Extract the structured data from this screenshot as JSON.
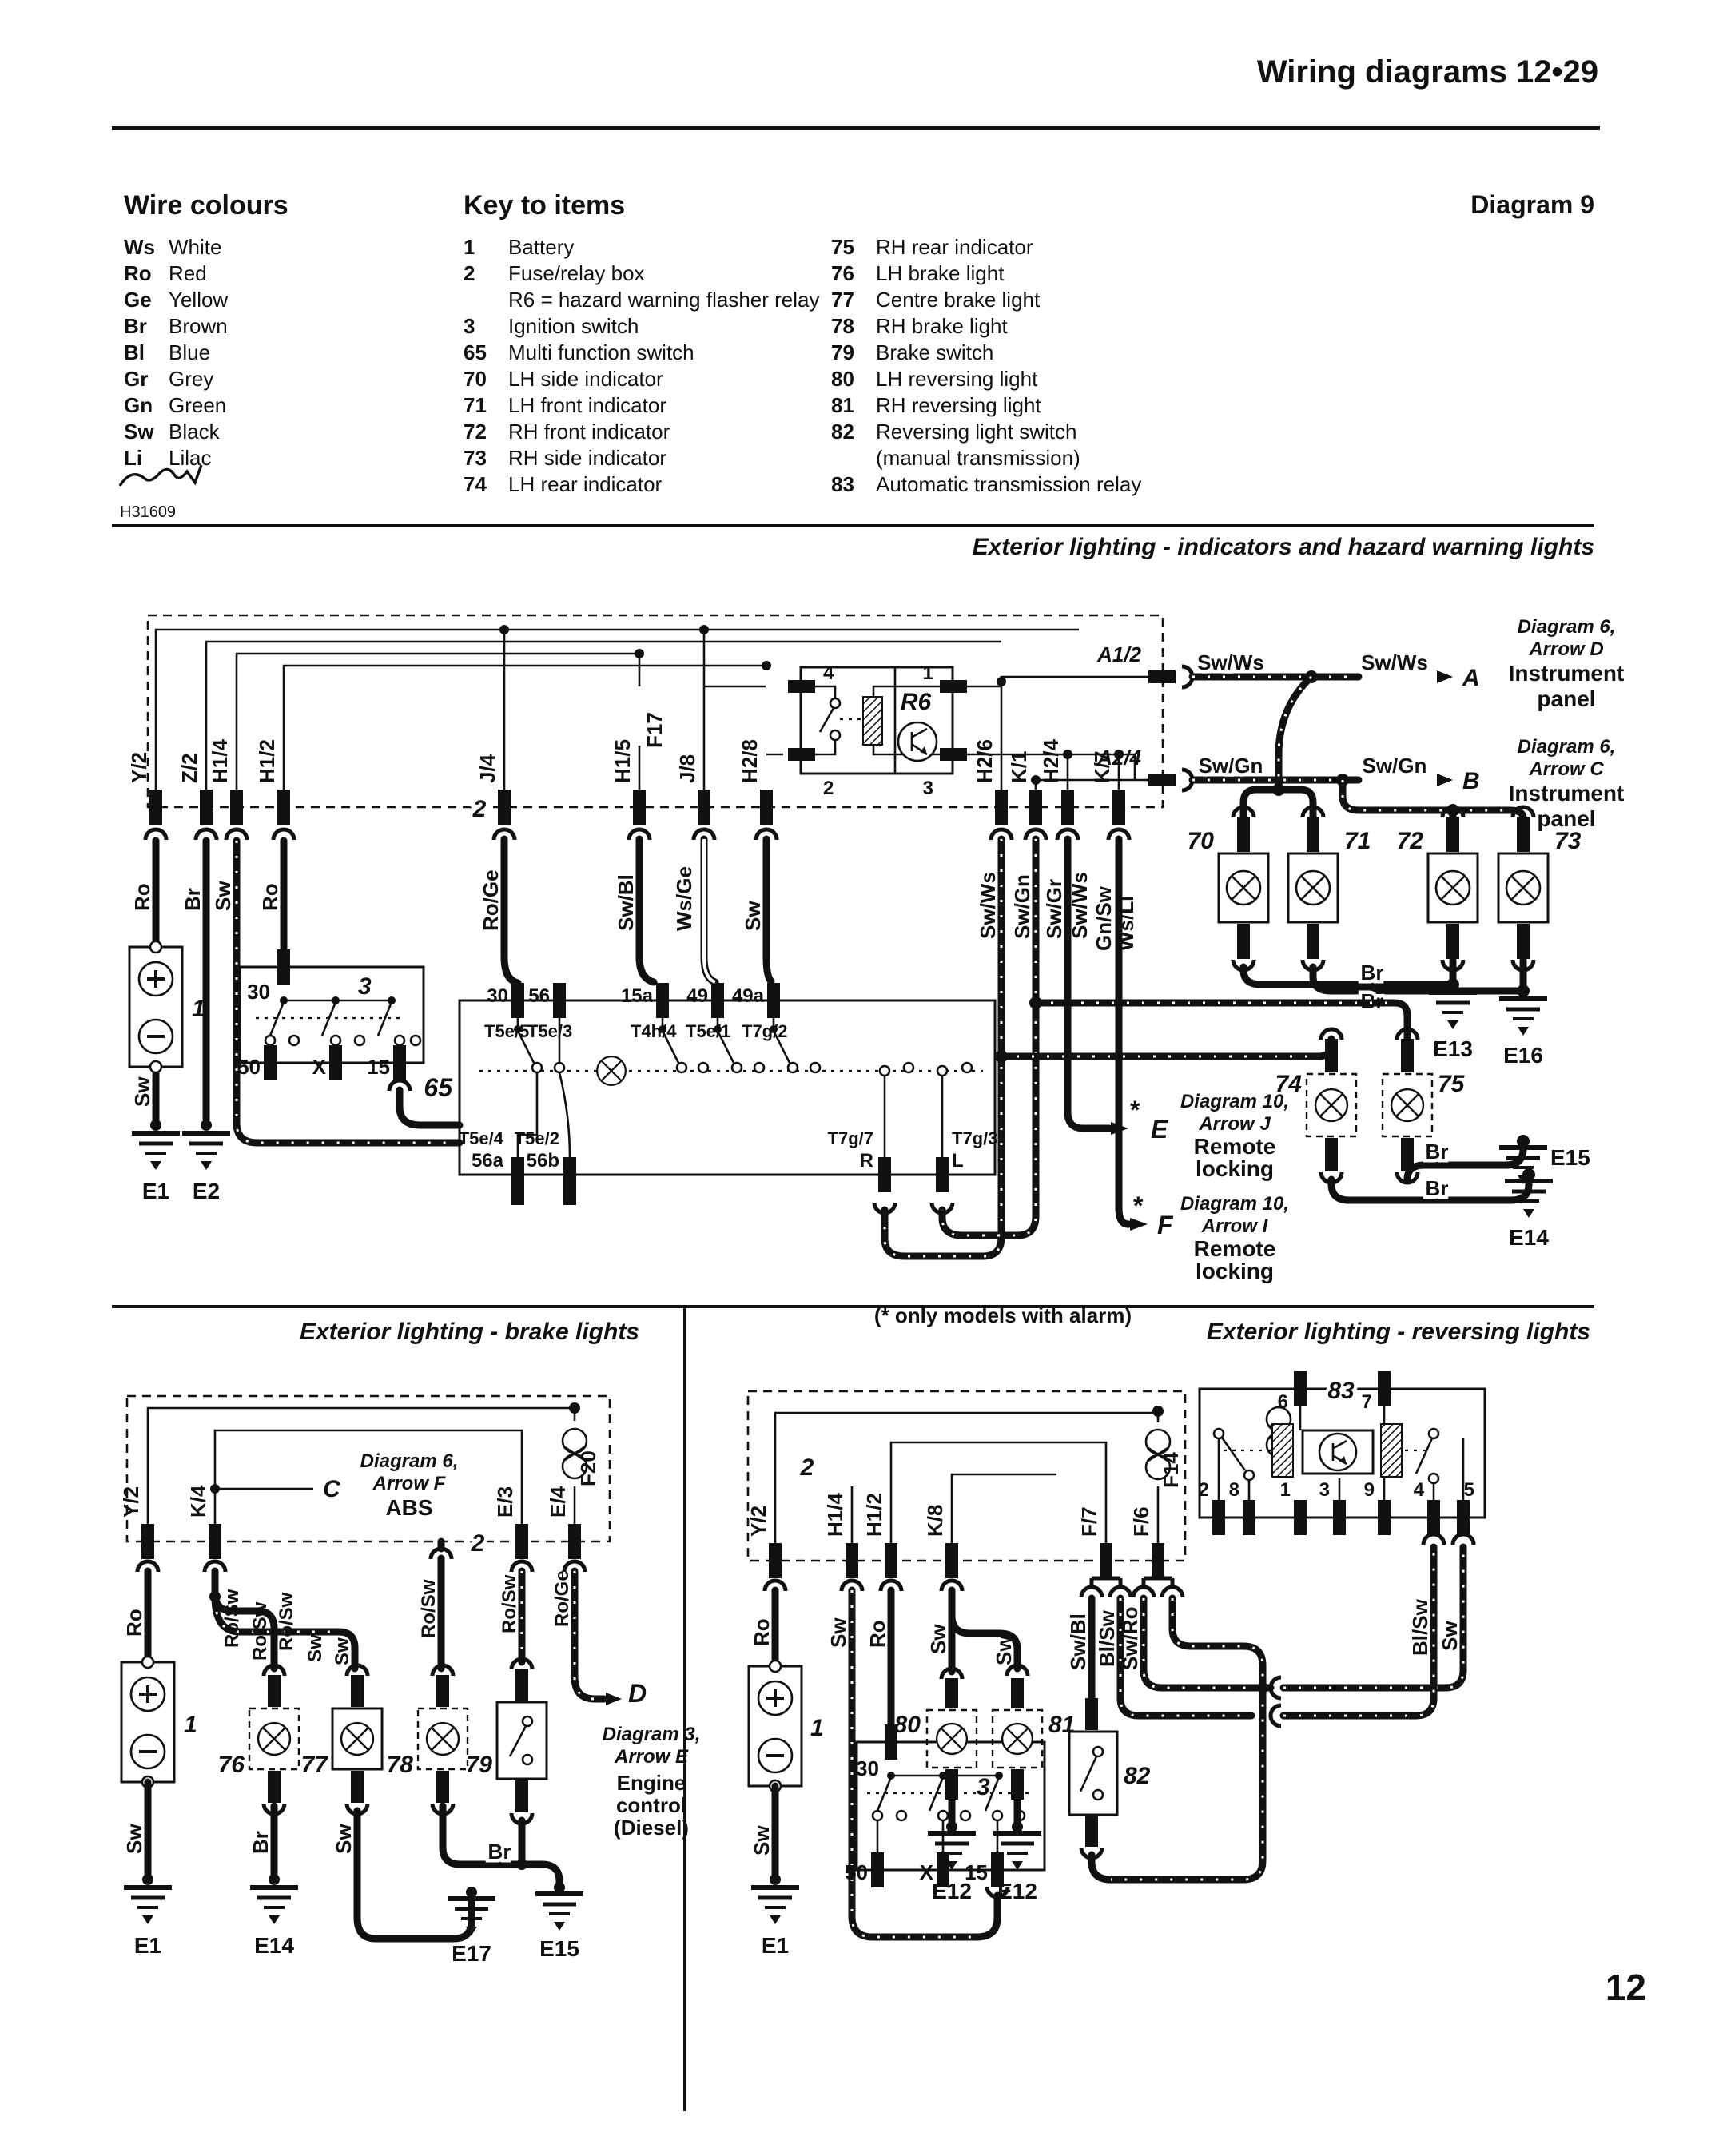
{
  "header": {
    "title": "Wiring diagrams  12•29"
  },
  "diagram_label": "Diagram 9",
  "sig": "H31609",
  "legend": {
    "title": "Wire colours",
    "items": [
      {
        "code": "Ws",
        "name": "White"
      },
      {
        "code": "Ro",
        "name": "Red"
      },
      {
        "code": "Ge",
        "name": "Yellow"
      },
      {
        "code": "Br",
        "name": "Brown"
      },
      {
        "code": "Bl",
        "name": "Blue"
      },
      {
        "code": "Gr",
        "name": "Grey"
      },
      {
        "code": "Gn",
        "name": "Green"
      },
      {
        "code": "Sw",
        "name": "Black"
      },
      {
        "code": "Li",
        "name": "Lilac"
      }
    ]
  },
  "key": {
    "title": "Key to items",
    "col1": [
      {
        "num": "1",
        "label": "Battery"
      },
      {
        "num": "2",
        "label": "Fuse/relay box"
      },
      {
        "num": "",
        "label": "R6 = hazard warning flasher relay"
      },
      {
        "num": "3",
        "label": "Ignition switch"
      },
      {
        "num": "65",
        "label": "Multi function switch"
      },
      {
        "num": "70",
        "label": "LH side indicator"
      },
      {
        "num": "71",
        "label": "LH front indicator"
      },
      {
        "num": "72",
        "label": "RH front indicator"
      },
      {
        "num": "73",
        "label": "RH side indicator"
      },
      {
        "num": "74",
        "label": "LH rear indicator"
      }
    ],
    "col2": [
      {
        "num": "75",
        "label": "RH rear indicator"
      },
      {
        "num": "76",
        "label": "LH brake light"
      },
      {
        "num": "77",
        "label": "Centre brake light"
      },
      {
        "num": "78",
        "label": "RH brake light"
      },
      {
        "num": "79",
        "label": "Brake switch"
      },
      {
        "num": "80",
        "label": "LH reversing light"
      },
      {
        "num": "81",
        "label": "RH reversing light"
      },
      {
        "num": "82",
        "label": "Reversing light switch"
      },
      {
        "num": "",
        "label": "(manual transmission)"
      },
      {
        "num": "83",
        "label": "Automatic transmission relay"
      }
    ]
  },
  "sections": {
    "indicators": "Exterior lighting - indicators and hazard warning lights",
    "brake": "Exterior lighting - brake lights",
    "reversing": "Exterior lighting - reversing lights"
  },
  "page": "12",
  "w": {
    "ro": "Ro",
    "br": "Br",
    "sw": "Sw",
    "roge": "Ro/Ge",
    "swbl": "Sw/Bl",
    "wsge": "Ws/Ge",
    "swws": "Sw/Ws",
    "swgn": "Sw/Gn",
    "swgr": "Sw/Gr",
    "gnsw": "Gn/Sw",
    "wsli": "Ws/Li",
    "rosw": "Ro/Sw",
    "blsw": "Bl/Sw",
    "swro": "Sw/Ro"
  },
  "conn": {
    "y2": "Y/2",
    "z2": "Z/2",
    "h14": "H1/4",
    "h12": "H1/2",
    "j4": "J/4",
    "h15": "H1/5",
    "j8": "J/8",
    "h28": "H2/8",
    "h26": "H2/6",
    "h24": "H2/4",
    "k1": "K/1",
    "k7": "K/7",
    "a12": "A1/2",
    "a24": "A2/4",
    "k4": "K/4",
    "e3": "E/3",
    "e4": "E/4",
    "k8": "K/8",
    "f7": "F/7",
    "f6": "F/6"
  },
  "term": {
    "t30": "30",
    "t56": "56",
    "t15a": "15a",
    "t49": "49",
    "t49a": "49a",
    "t5e5": "T5e/5",
    "t5e3": "T5e/3",
    "t4h4": "T4h/4",
    "t5e1": "T5e/1",
    "t7g2": "T7g/2",
    "t5e4": "T5e/4",
    "n56a": "56a",
    "t5e2": "T5e/2",
    "n56b": "56b",
    "t7g7": "T7g/7",
    "r": "R",
    "t7g3": "T7g/3",
    "l": "L",
    "t50": "50",
    "tx": "X",
    "t15": "15"
  },
  "comp": {
    "c1": "1",
    "c2": "2",
    "c3": "3",
    "c65": "65",
    "c70": "70",
    "c71": "71",
    "c72": "72",
    "c73": "73",
    "c74": "74",
    "c75": "75",
    "c76": "76",
    "c77": "77",
    "c78": "78",
    "c79": "79",
    "c80": "80",
    "c81": "81",
    "c82": "82",
    "c83": "83",
    "r6": "R6",
    "f17": "F17",
    "f20": "F20",
    "f14": "F14"
  },
  "gnd": {
    "e1": "E1",
    "e2": "E2",
    "e12": "E12",
    "e13": "E13",
    "e14": "E14",
    "e15": "E15",
    "e16": "E16",
    "e17": "E17"
  },
  "pins": {
    "p1": "1",
    "p2": "2",
    "p3": "3",
    "p4": "4",
    "p5": "5",
    "p6": "6",
    "p7": "7",
    "p8": "8",
    "p9": "9"
  },
  "notes": {
    "a": "A",
    "b": "B",
    "c": "C",
    "d": "D",
    "e": "E",
    "f": "F",
    "star": "*",
    "diag6": "Diagram 6,",
    "arrow_d": "Arrow D",
    "arrow_c": "Arrow C",
    "instr": "Instrument",
    "panel": "panel",
    "diag10": "Diagram 10,",
    "arrow_j": "Arrow J",
    "arrow_i": "Arrow I",
    "remote": "Remote",
    "locking": "locking",
    "alarm": "(* only models with alarm)",
    "arrow_f": "Arrow F",
    "abs": "ABS",
    "diag3": "Diagram 3,",
    "arrow_e": "Arrow E",
    "eng": "Engine",
    "ctrl": "control",
    "diesel": "(Diesel)"
  }
}
